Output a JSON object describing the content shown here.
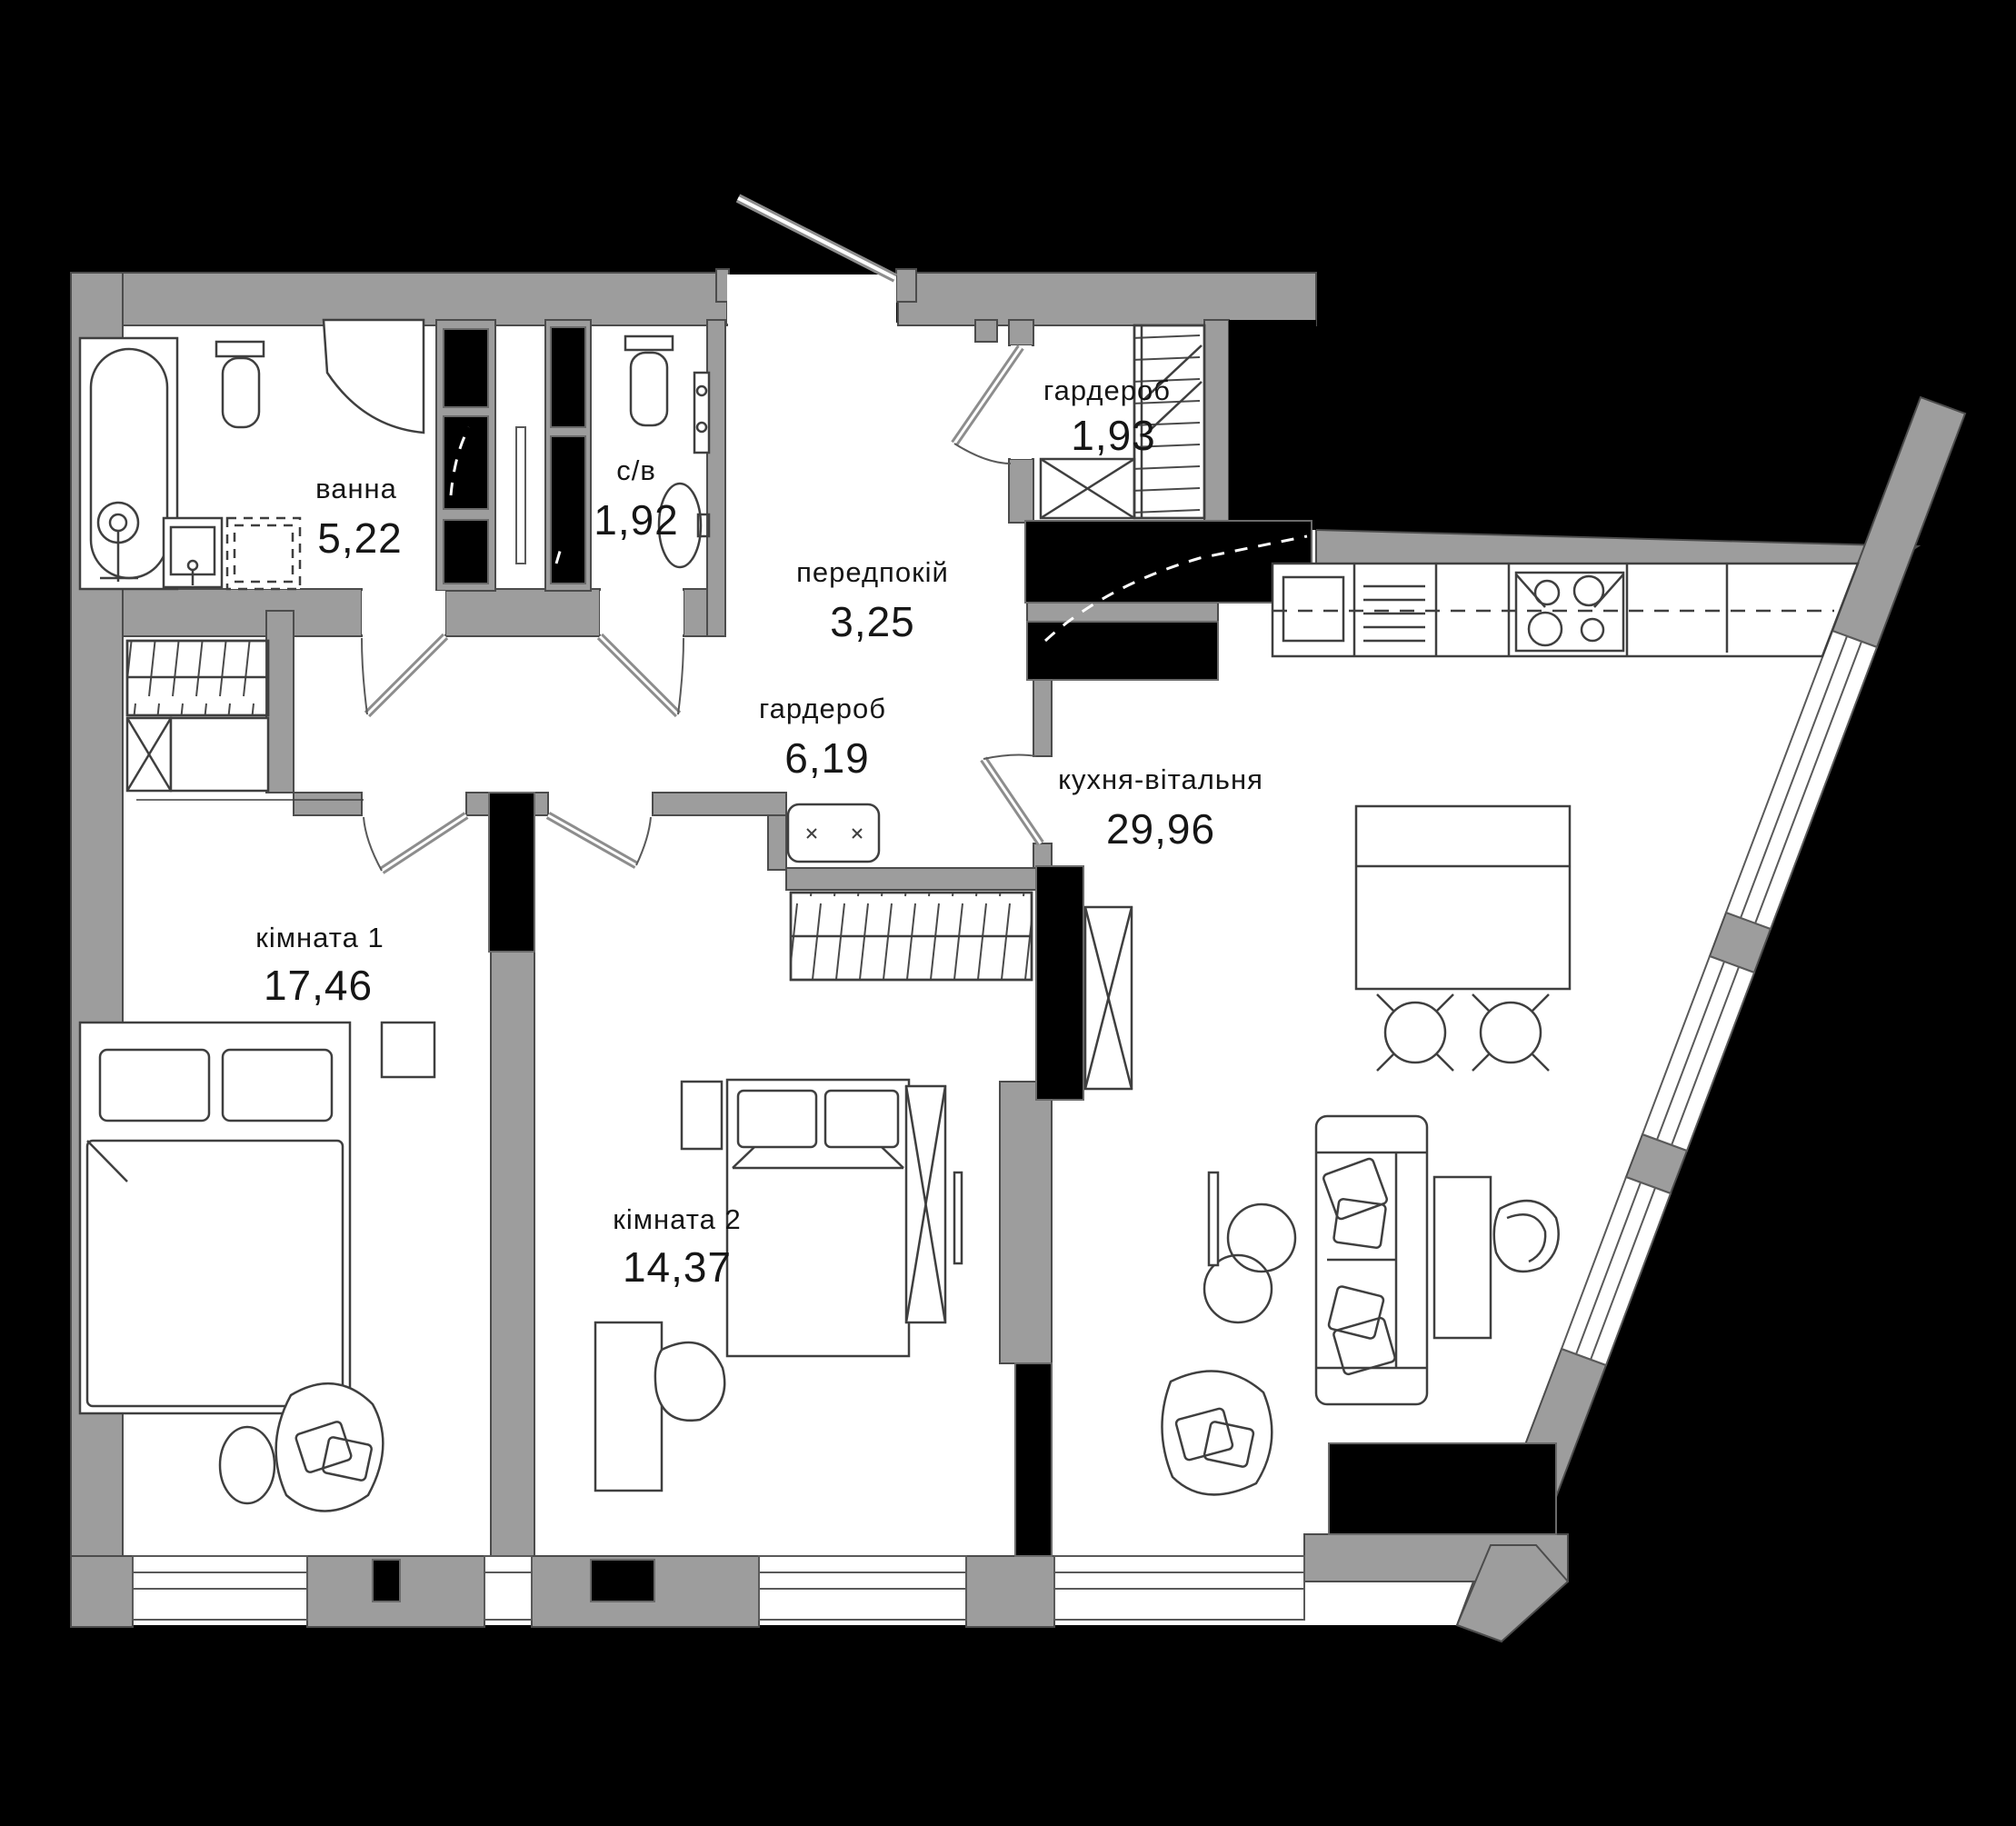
{
  "plan": {
    "type": "apartment-floor-plan",
    "colors": {
      "background": "#000000",
      "wall": "#9d9d9d",
      "wall_edge": "#4c4c4c",
      "shaft": "#000000",
      "floor": "#ffffff",
      "furniture_line": "#3f3f3f",
      "text": "#161616"
    }
  },
  "rooms": {
    "bathroom": {
      "name": "ванна",
      "area": "5,22"
    },
    "wc": {
      "name": "с/в",
      "area": "1,92"
    },
    "hallway": {
      "name": "передпокій",
      "area": "3,25"
    },
    "wardrobe_small": {
      "name": "гардероб",
      "area": "1,93"
    },
    "wardrobe_large": {
      "name": "гардероб",
      "area": "6,19"
    },
    "room1": {
      "name": "кімната 1",
      "area": "17,46"
    },
    "room2": {
      "name": "кімната 2",
      "area": "14,37"
    },
    "kitchen_living": {
      "name": "кухня-вітальня",
      "area": "29,96"
    }
  }
}
